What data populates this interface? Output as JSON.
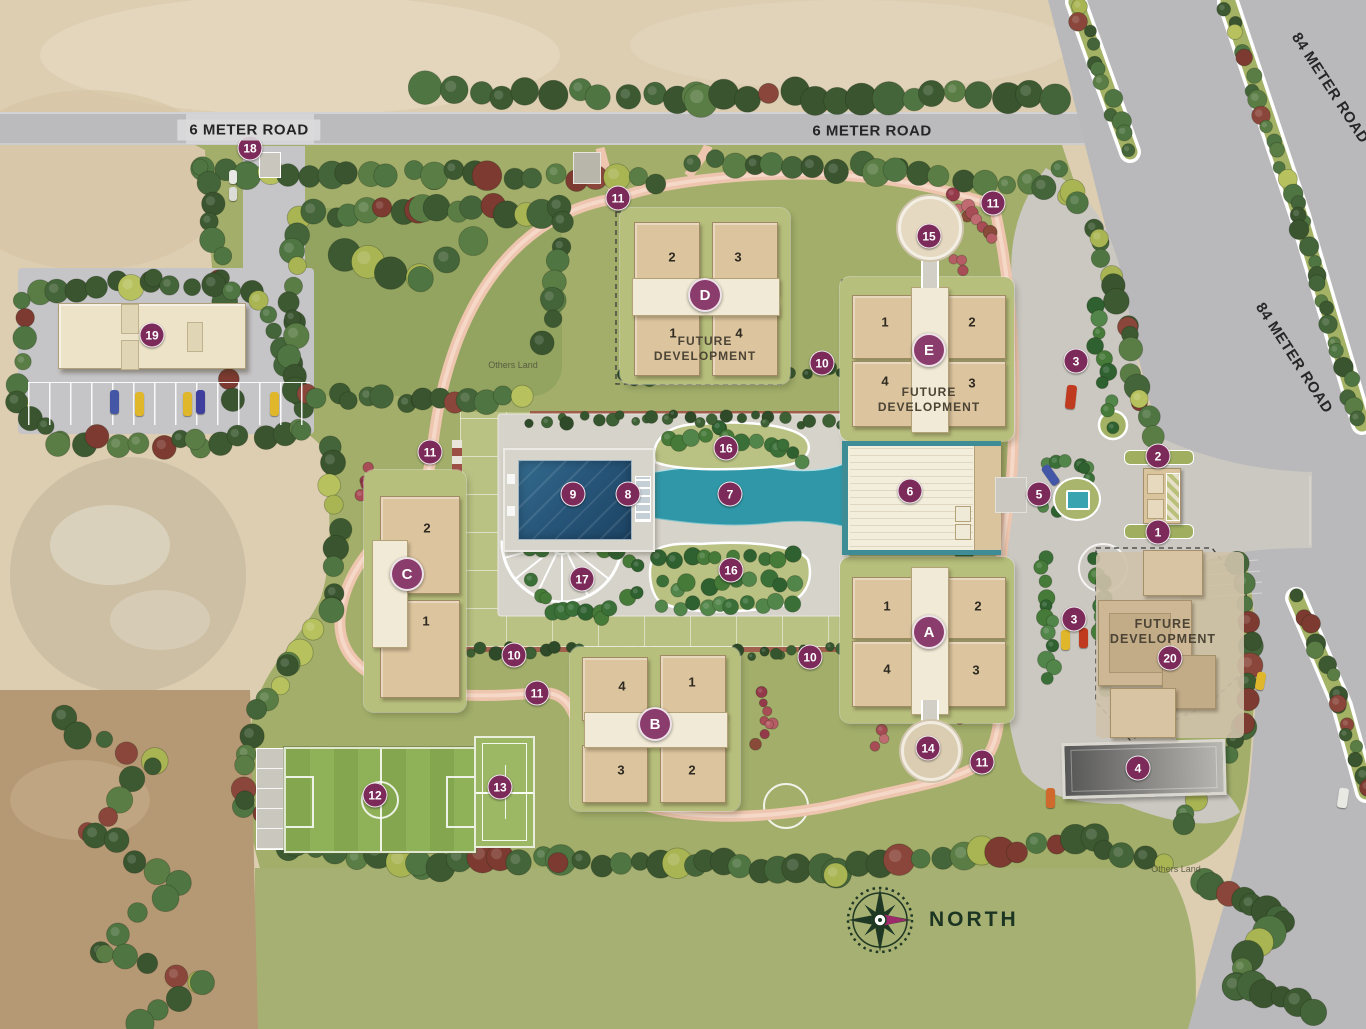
{
  "theme": {
    "marker_bg": "#7c2a5a",
    "letter_badge_bg": "#8a3c6c",
    "path_salmon": "#eec5ae",
    "pool_blue": "#27567a",
    "channel_teal": "#2f97a7",
    "site_green": "#a2ae6a"
  },
  "roads": {
    "six_meter": [
      "6 METER ROAD",
      "6 METER ROAD"
    ],
    "eighty_four_meter": [
      "84 METER ROAD",
      "84 METER ROAD"
    ]
  },
  "labels": {
    "north": "NORTH",
    "others_land_1": "Others Land",
    "others_land_2": "Others Land"
  },
  "towers": [
    {
      "letter": "D",
      "units": {
        "tl": "2",
        "tr": "3",
        "bl": "1",
        "br": "4"
      },
      "future_line1": "FUTURE",
      "future_line2": "DEVELOPMENT"
    },
    {
      "letter": "E",
      "units": {
        "tl": "1",
        "tr": "2",
        "bl": "4",
        "br": "3"
      },
      "future_line1": "FUTURE",
      "future_line2": "DEVELOPMENT"
    },
    {
      "letter": "A",
      "units": {
        "tl": "1",
        "tr": "2",
        "bl": "4",
        "br": "3"
      }
    },
    {
      "letter": "B",
      "units": {
        "tl": "4",
        "tr": "1",
        "bl": "3",
        "br": "2"
      }
    },
    {
      "letter": "C",
      "units": {
        "top": "2",
        "bottom": "1"
      }
    }
  ],
  "future_site": {
    "line1": "FUTURE",
    "line2": "DEVELOPMENT"
  },
  "markers": [
    {
      "label": "18",
      "x": 250,
      "y": 148
    },
    {
      "label": "19",
      "x": 152,
      "y": 335
    },
    {
      "label": "11",
      "x": 618,
      "y": 198
    },
    {
      "label": "11",
      "x": 993,
      "y": 203
    },
    {
      "label": "15",
      "x": 929,
      "y": 236
    },
    {
      "label": "10",
      "x": 822,
      "y": 363
    },
    {
      "label": "3",
      "x": 1076,
      "y": 361
    },
    {
      "label": "2",
      "x": 1158,
      "y": 456
    },
    {
      "label": "11",
      "x": 430,
      "y": 452
    },
    {
      "label": "16",
      "x": 726,
      "y": 448
    },
    {
      "label": "9",
      "x": 573,
      "y": 494
    },
    {
      "label": "8",
      "x": 628,
      "y": 494
    },
    {
      "label": "7",
      "x": 730,
      "y": 494
    },
    {
      "label": "6",
      "x": 910,
      "y": 491
    },
    {
      "label": "5",
      "x": 1039,
      "y": 494
    },
    {
      "label": "1",
      "x": 1158,
      "y": 532
    },
    {
      "label": "17",
      "x": 582,
      "y": 579
    },
    {
      "label": "16",
      "x": 731,
      "y": 570
    },
    {
      "label": "3",
      "x": 1074,
      "y": 619
    },
    {
      "label": "10",
      "x": 514,
      "y": 655
    },
    {
      "label": "10",
      "x": 810,
      "y": 657
    },
    {
      "label": "20",
      "x": 1170,
      "y": 658
    },
    {
      "label": "11",
      "x": 537,
      "y": 693
    },
    {
      "label": "14",
      "x": 928,
      "y": 748
    },
    {
      "label": "11",
      "x": 982,
      "y": 762
    },
    {
      "label": "4",
      "x": 1138,
      "y": 768
    },
    {
      "label": "12",
      "x": 375,
      "y": 795
    },
    {
      "label": "13",
      "x": 500,
      "y": 787
    }
  ]
}
